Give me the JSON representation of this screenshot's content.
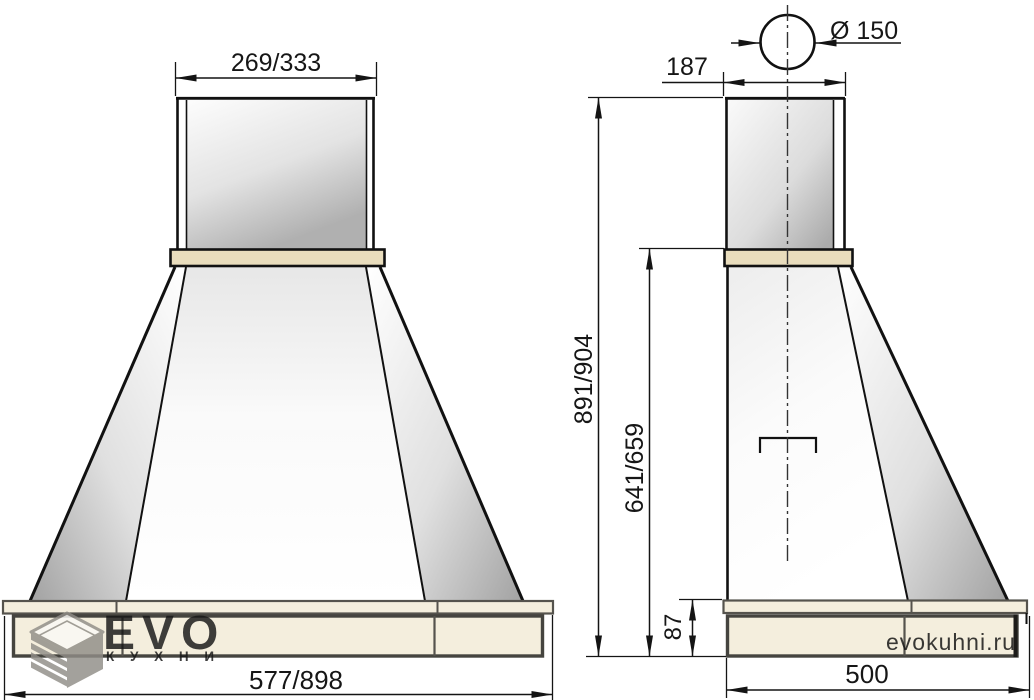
{
  "dimensions": {
    "front_top_width": "269/333",
    "front_bottom_width": "577/898",
    "duct_diameter": "Ø 150",
    "side_top_depth": "187",
    "total_height": "891/904",
    "canopy_height": "641/659",
    "base_height": "87",
    "side_bottom_depth": "500"
  },
  "branding": {
    "logo_text": "EVO",
    "logo_subtext": "К У Х Н И",
    "watermark": "evokuhni.ru"
  },
  "colors": {
    "outline": "#111111",
    "dimension_line": "#141414",
    "band_fill": "#e9ddbd",
    "base_fill": "#f4eedd",
    "base_border": "#55534d",
    "metal_dark": "#b0b0b0",
    "logo_grey": "#908d87",
    "watermark_grey": "#d0cabb"
  }
}
